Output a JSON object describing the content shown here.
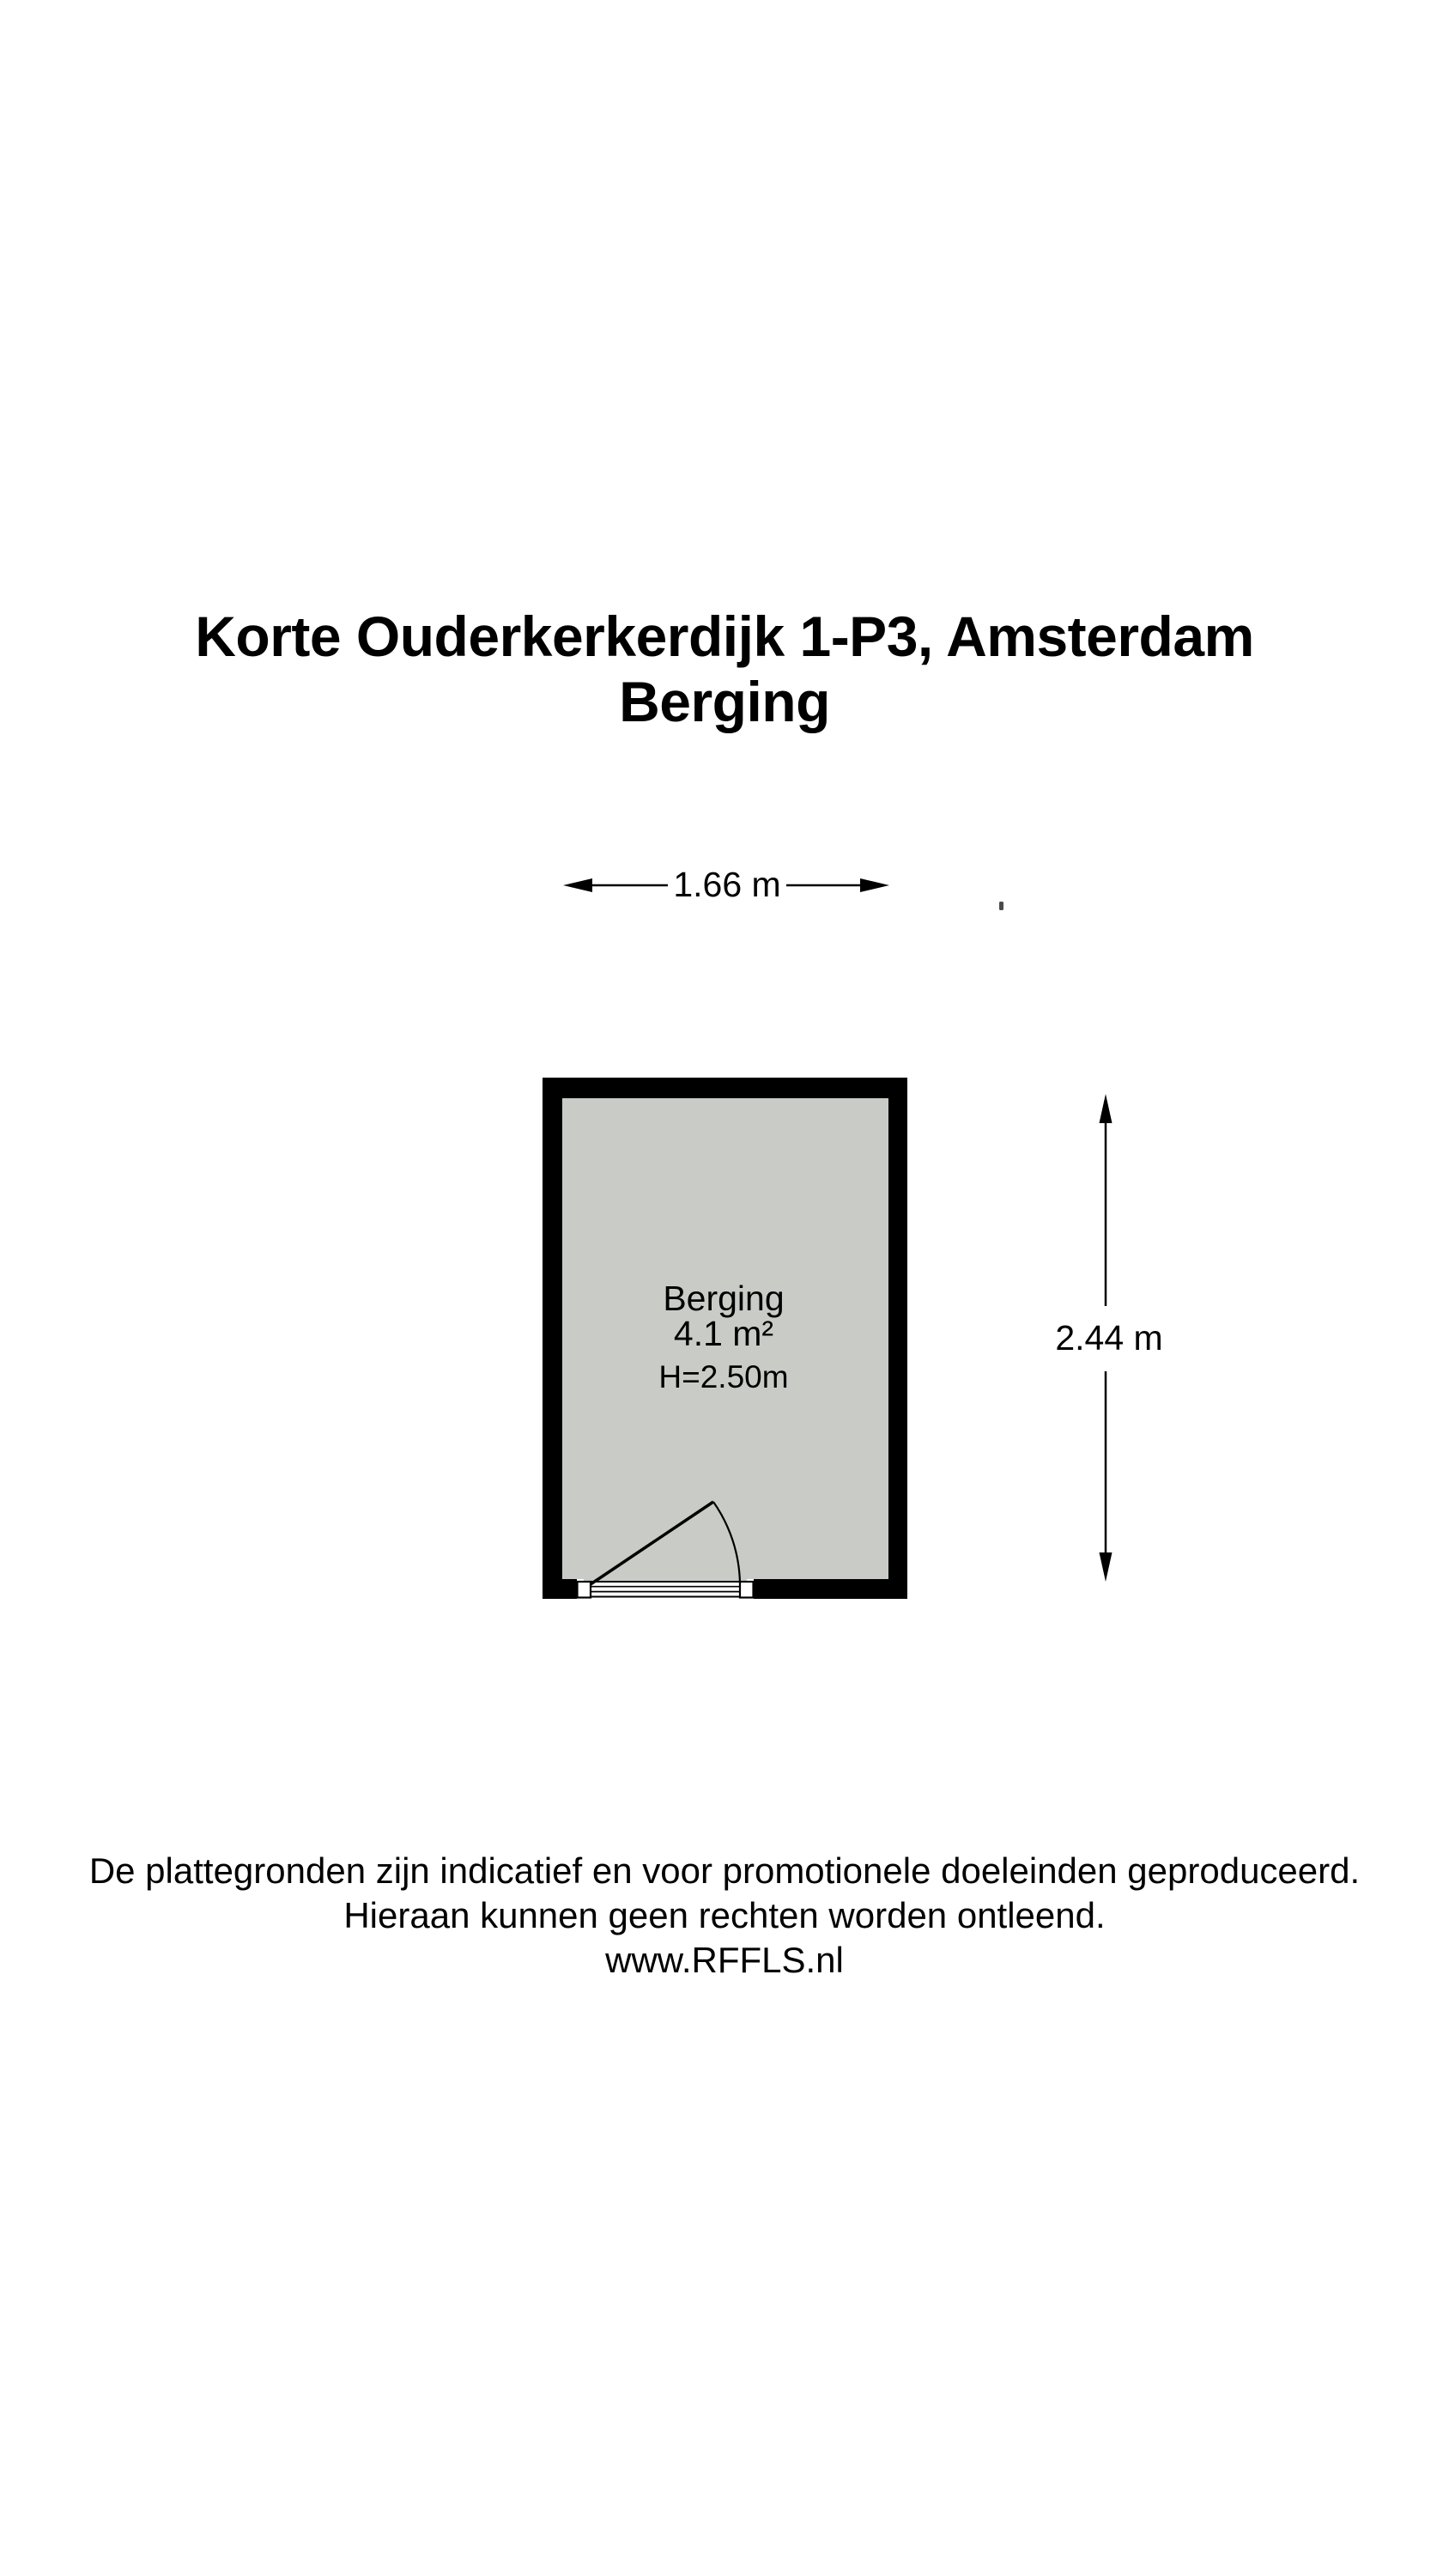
{
  "title": {
    "address": "Korte Ouderkerkerdijk 1-P3, Amsterdam",
    "subtitle": "Berging"
  },
  "room": {
    "name": "Berging",
    "area": "4.1 m²",
    "ceiling_height": "H=2.50m"
  },
  "dimensions": {
    "width_label": "1.66 m",
    "depth_label": "2.44 m"
  },
  "footer": {
    "line1": "De plattegronden zijn indicatief en voor promotionele doeleinden geproduceerd.",
    "line2": "Hieraan kunnen geen rechten worden ontleend.",
    "line3": "www.RFFLS.nl"
  },
  "colors": {
    "wall": "#000000",
    "room_fill": "#c9ccc6",
    "line": "#000000",
    "opening": "#ffffff",
    "background": "#ffffff"
  }
}
